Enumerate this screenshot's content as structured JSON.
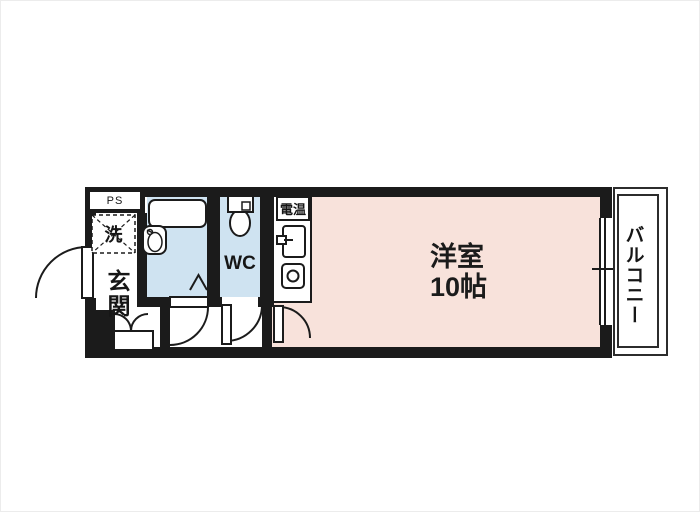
{
  "plan": {
    "labels": {
      "ps": "PS",
      "laundry": "洗",
      "entrance": "玄関",
      "wc": "WC",
      "water_heater": "電温",
      "room_name": "洋室",
      "room_size": "10帖",
      "balcony": "バルコニー"
    },
    "colors": {
      "wall": "#1b1b1b",
      "room_pink": "#f8e2db",
      "wet_area_blue": "#cfe3f1",
      "floor_white": "#ffffff"
    }
  }
}
